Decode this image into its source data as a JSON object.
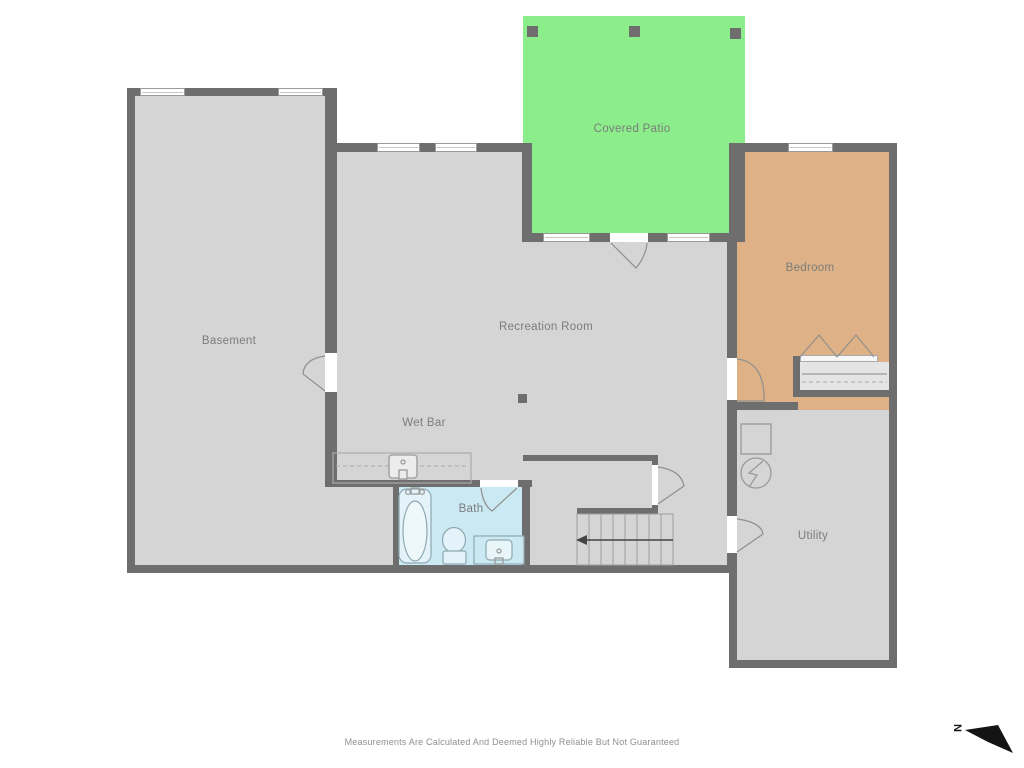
{
  "plan": {
    "rooms": [
      {
        "id": "covered-patio",
        "label": "Covered Patio"
      },
      {
        "id": "basement",
        "label": "Basement"
      },
      {
        "id": "recreation-room",
        "label": "Recreation Room"
      },
      {
        "id": "wet-bar",
        "label": "Wet Bar"
      },
      {
        "id": "bath",
        "label": "Bath"
      },
      {
        "id": "bedroom",
        "label": "Bedroom"
      },
      {
        "id": "utility",
        "label": "Utility"
      }
    ],
    "colors": {
      "outside": "#ffffff",
      "floor": "#d5d5d5",
      "wall": "#6e6e6e",
      "patio": "#8bee8b",
      "bedroom": "#deb286",
      "bath": "#cbe9f2",
      "closet": "#e4e4e4",
      "window-fill": "#ffffff",
      "fixture-stroke": "#9a9a9a",
      "label": "#7c7c7c",
      "compass": "#141414"
    },
    "compass": {
      "label": "N"
    },
    "footer": {
      "disclaimer": "Measurements Are Calculated And Deemed Highly Reliable But Not Guaranteed"
    }
  }
}
